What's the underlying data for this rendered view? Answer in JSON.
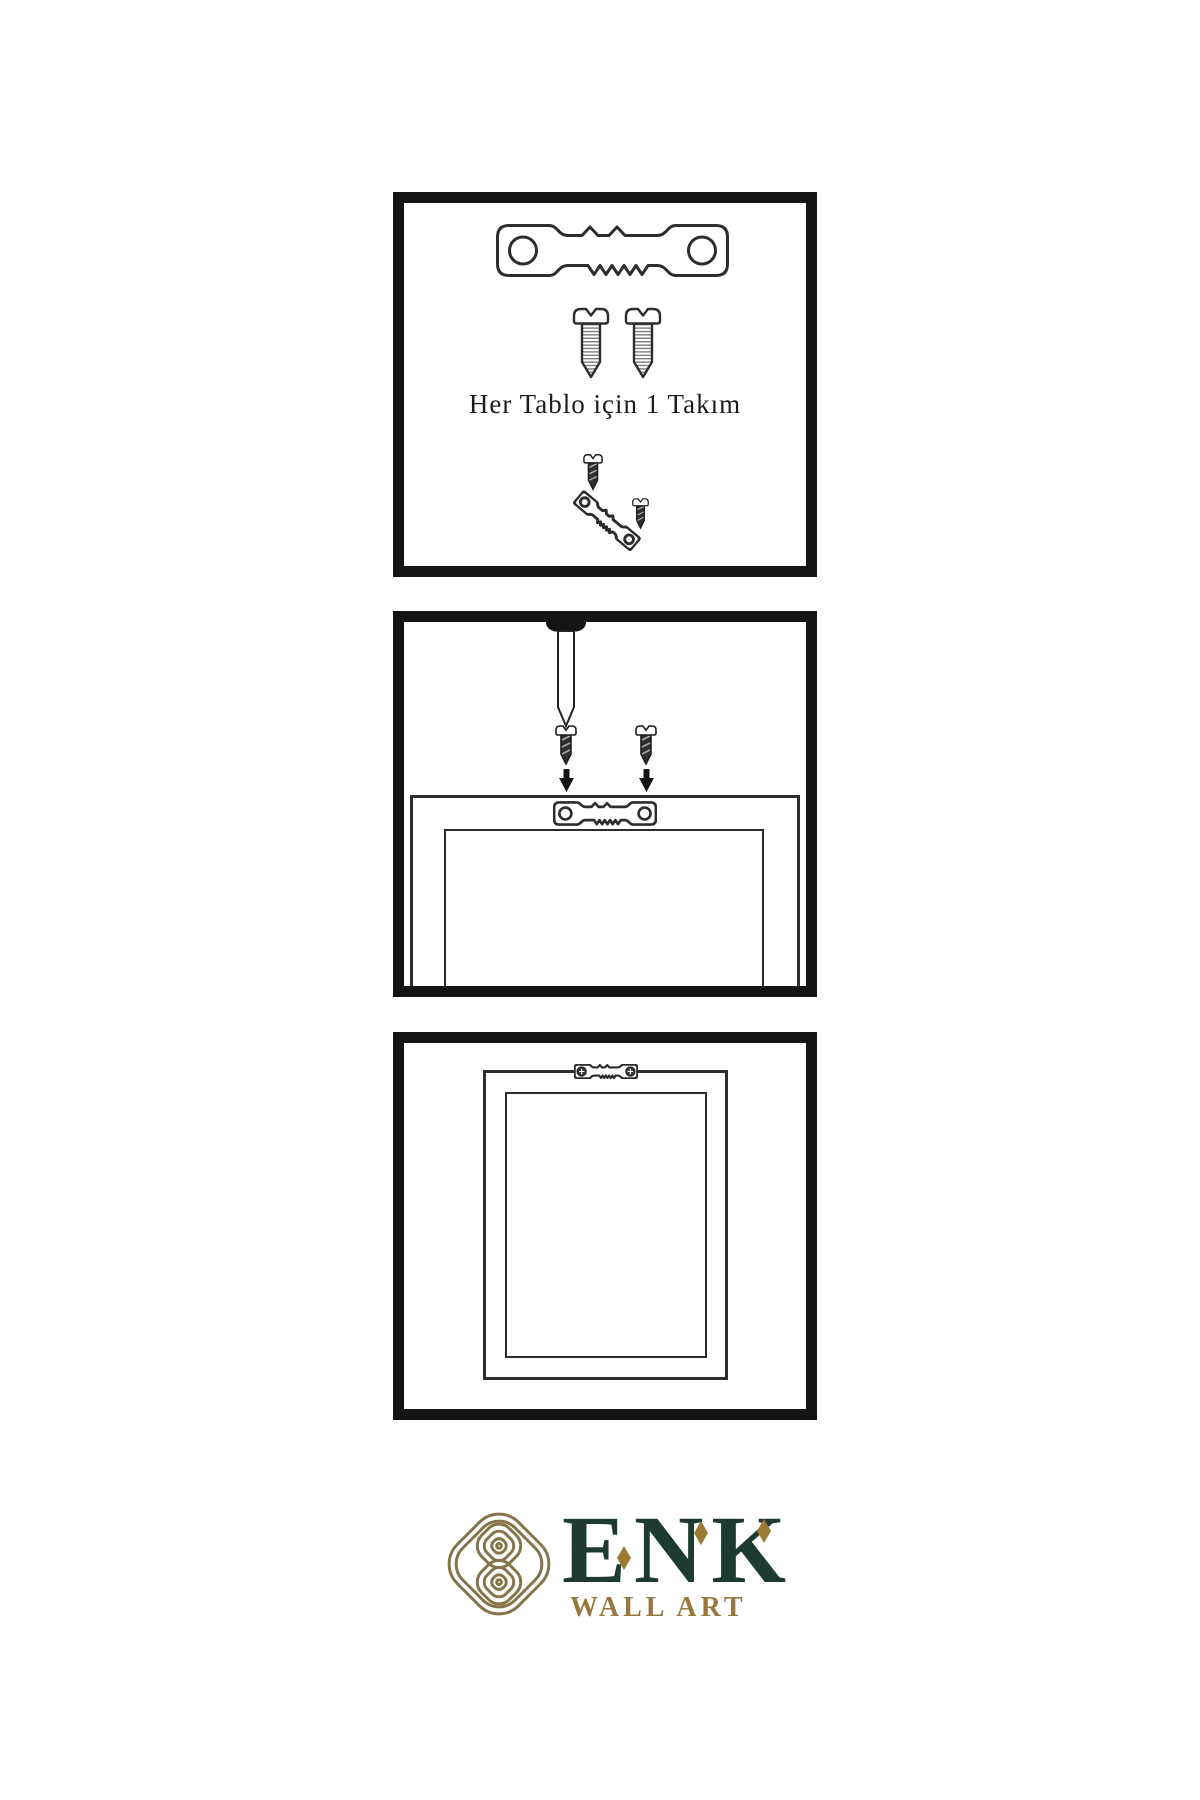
{
  "page": {
    "bg": "#ffffff"
  },
  "colors": {
    "page_bg": "#ffffff",
    "panel_border": "#141414",
    "ink": "#2d2d2d",
    "brand_green": "#1e3b30",
    "brand_gold": "#9c7c35",
    "tagline_gold": "#97793f",
    "emblem_gold": "#847448"
  },
  "steps": {
    "hardware": {
      "caption": "Her Tablo için 1 Takım",
      "icons": [
        "sawtooth-hanger-icon",
        "screw-icon",
        "screw-icon",
        "hanger-assembly-icon"
      ]
    },
    "wall_mounting": {
      "icons": [
        "nail-icon",
        "screw-icon",
        "screw-icon",
        "arrow-down-icon",
        "arrow-down-icon",
        "sawtooth-hanger-icon",
        "picture-frame-icon"
      ]
    },
    "hanging": {
      "icons": [
        "picture-frame-icon",
        "sawtooth-hanger-mounted-icon"
      ]
    }
  },
  "brand": {
    "name": "ENK",
    "tagline": "WALL ART",
    "emblem": "knot-emblem-icon"
  }
}
